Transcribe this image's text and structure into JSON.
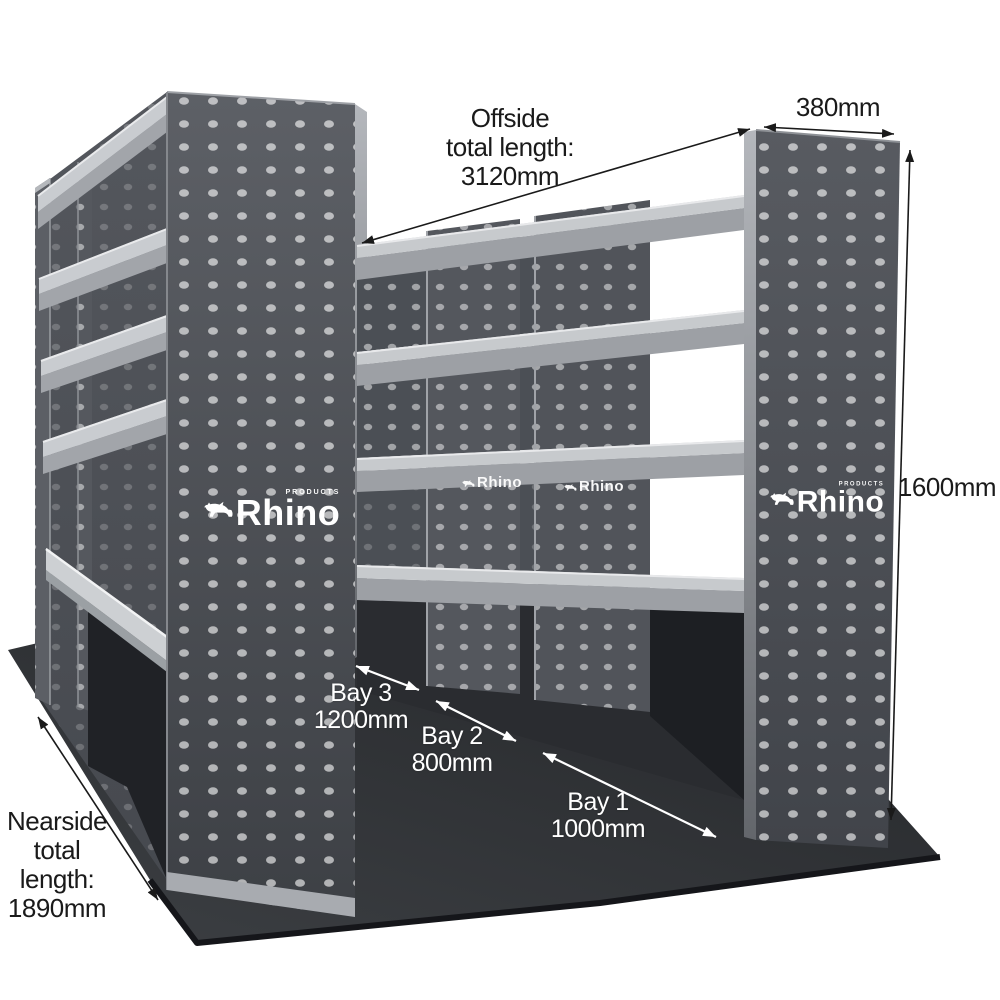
{
  "product": {
    "brand": "Rhino",
    "products_caption": "PRODUCTS"
  },
  "annotations": {
    "offside": {
      "lines": [
        "Offside",
        "total length:",
        "3120mm"
      ]
    },
    "depth": "380mm",
    "height": "1600mm",
    "bays": [
      {
        "name": "Bay 3",
        "size": "1200mm"
      },
      {
        "name": "Bay 2",
        "size": "800mm"
      },
      {
        "name": "Bay 1",
        "size": "1000mm"
      }
    ],
    "nearside": {
      "lines": [
        "Nearside",
        "total",
        "length:",
        "1890mm"
      ]
    }
  },
  "colors": {
    "background": "#ffffff",
    "panel_dark": "#54575d",
    "shelf_light": "#c7cacd",
    "floor_mat": "#2e3134",
    "dimension_dark": "#1a1a1a",
    "dimension_light": "#ffffff"
  }
}
